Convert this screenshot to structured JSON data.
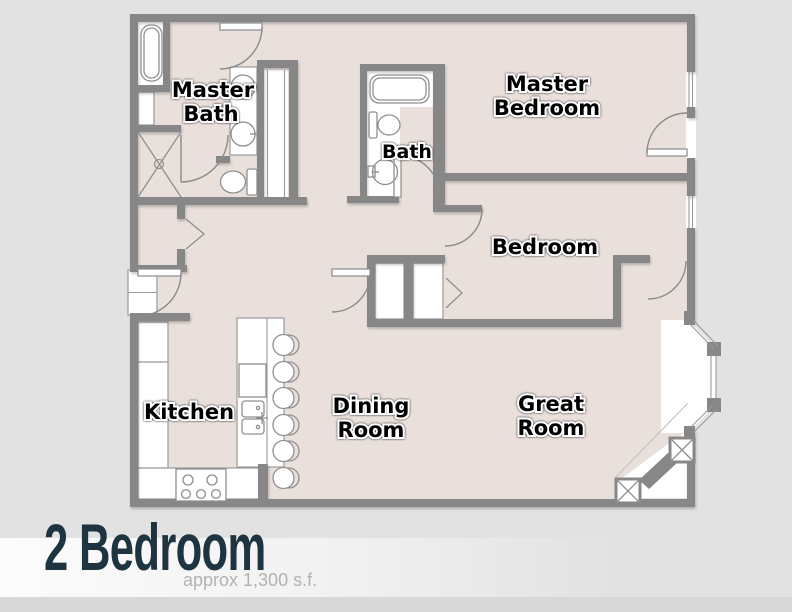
{
  "plan": {
    "rooms": {
      "master_bath": {
        "line1": "Master",
        "line2": "Bath"
      },
      "master_bedroom": {
        "line1": "Master",
        "line2": "Bedroom"
      },
      "bath": {
        "label": "Bath"
      },
      "bedroom": {
        "label": "Bedroom"
      },
      "kitchen": {
        "label": "Kitchen"
      },
      "dining_room": {
        "line1": "Dining",
        "line2": "Room"
      },
      "great_room": {
        "line1": "Great",
        "line2": "Room"
      }
    },
    "fixtures_shown": [
      "bathtub",
      "shower",
      "double-vanity",
      "toilet",
      "pedestal-sink",
      "kitchen-sink",
      "dishwasher",
      "range",
      "refrigerator",
      "bar-stools",
      "bifold-closet",
      "sliding-closet",
      "pocket-door",
      "bay-window",
      "corner-fireplace"
    ]
  },
  "footer": {
    "title": "2 Bedroom",
    "subtitle": "approx 1,300 s.f."
  },
  "colors": {
    "background": "#e3e2e2",
    "floor": "#eae0db",
    "walls": "#878787",
    "fixture_white": "#ffffff",
    "label_text": "#000000",
    "label_halo": "#ffffff",
    "title_text": "#1e3440",
    "subtitle_text": "#b3b2b2"
  }
}
